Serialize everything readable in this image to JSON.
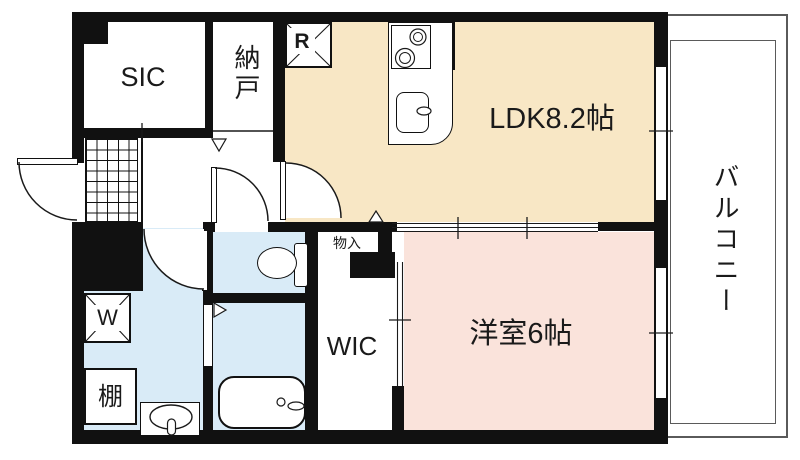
{
  "colors": {
    "ldk_fill": "#F8E7C5",
    "bedroom_fill": "#FAE3DB",
    "wet_fill": "#D9EBF7",
    "wall": "#111111",
    "line": "#1a1a1a",
    "balcony_line": "#5a5a5a"
  },
  "rooms": {
    "ldk": {
      "label": "LDK8.2帖"
    },
    "bedroom": {
      "label": "洋室6帖"
    },
    "sic": {
      "label": "SIC"
    },
    "nando": {
      "label": "納戸"
    },
    "wic": {
      "label": "WIC"
    },
    "monoire": {
      "label": "物入"
    },
    "balcony": {
      "label": "バルコニー"
    }
  },
  "fixtures": {
    "refrigerator": {
      "label": "R"
    },
    "washer": {
      "label": "W"
    },
    "shelf": {
      "label": "棚"
    }
  }
}
